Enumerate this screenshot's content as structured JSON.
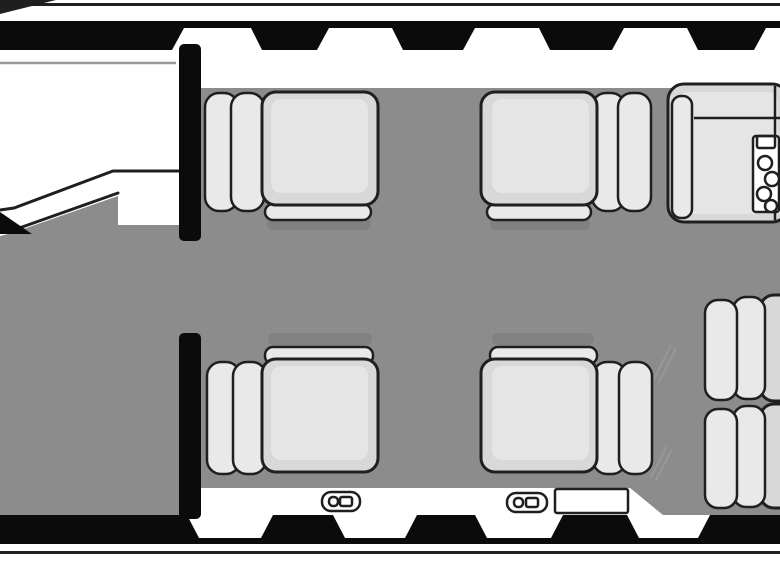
{
  "diagram": {
    "title": "Business-jet cabin floor plan, top view",
    "orientation": "nose at left, tail at right",
    "regions": {
      "cockpit": "white cockpit area forward-left with glareshield line and angled partition",
      "entry": "forward bulkhead with door cutout in upper hull",
      "main_cabin": "gray carpeted cabin with four club seats",
      "aft": "refreshment cabinet upper-right and two aft side seats lower-right"
    },
    "inventory": {
      "club_seats": 4,
      "aft_side_seats": 2,
      "refreshment_cabinets": 1,
      "cup_rack_circles": 4,
      "windows_top": 5,
      "windows_bottom": 4,
      "door_latch_markers": 2,
      "emergency_exit_markers": 1,
      "bulkheads": 2
    }
  },
  "palette": {
    "hull": "#0b0b0b",
    "outline": "#1f1f1f",
    "floor": "#8c8c8c",
    "seat": "#d8d8d8",
    "seat_light": "#e9e9e9",
    "wall_white": "#ffffff",
    "soft_line": "#9a9a9a",
    "shadow": "#6e6e6e"
  }
}
